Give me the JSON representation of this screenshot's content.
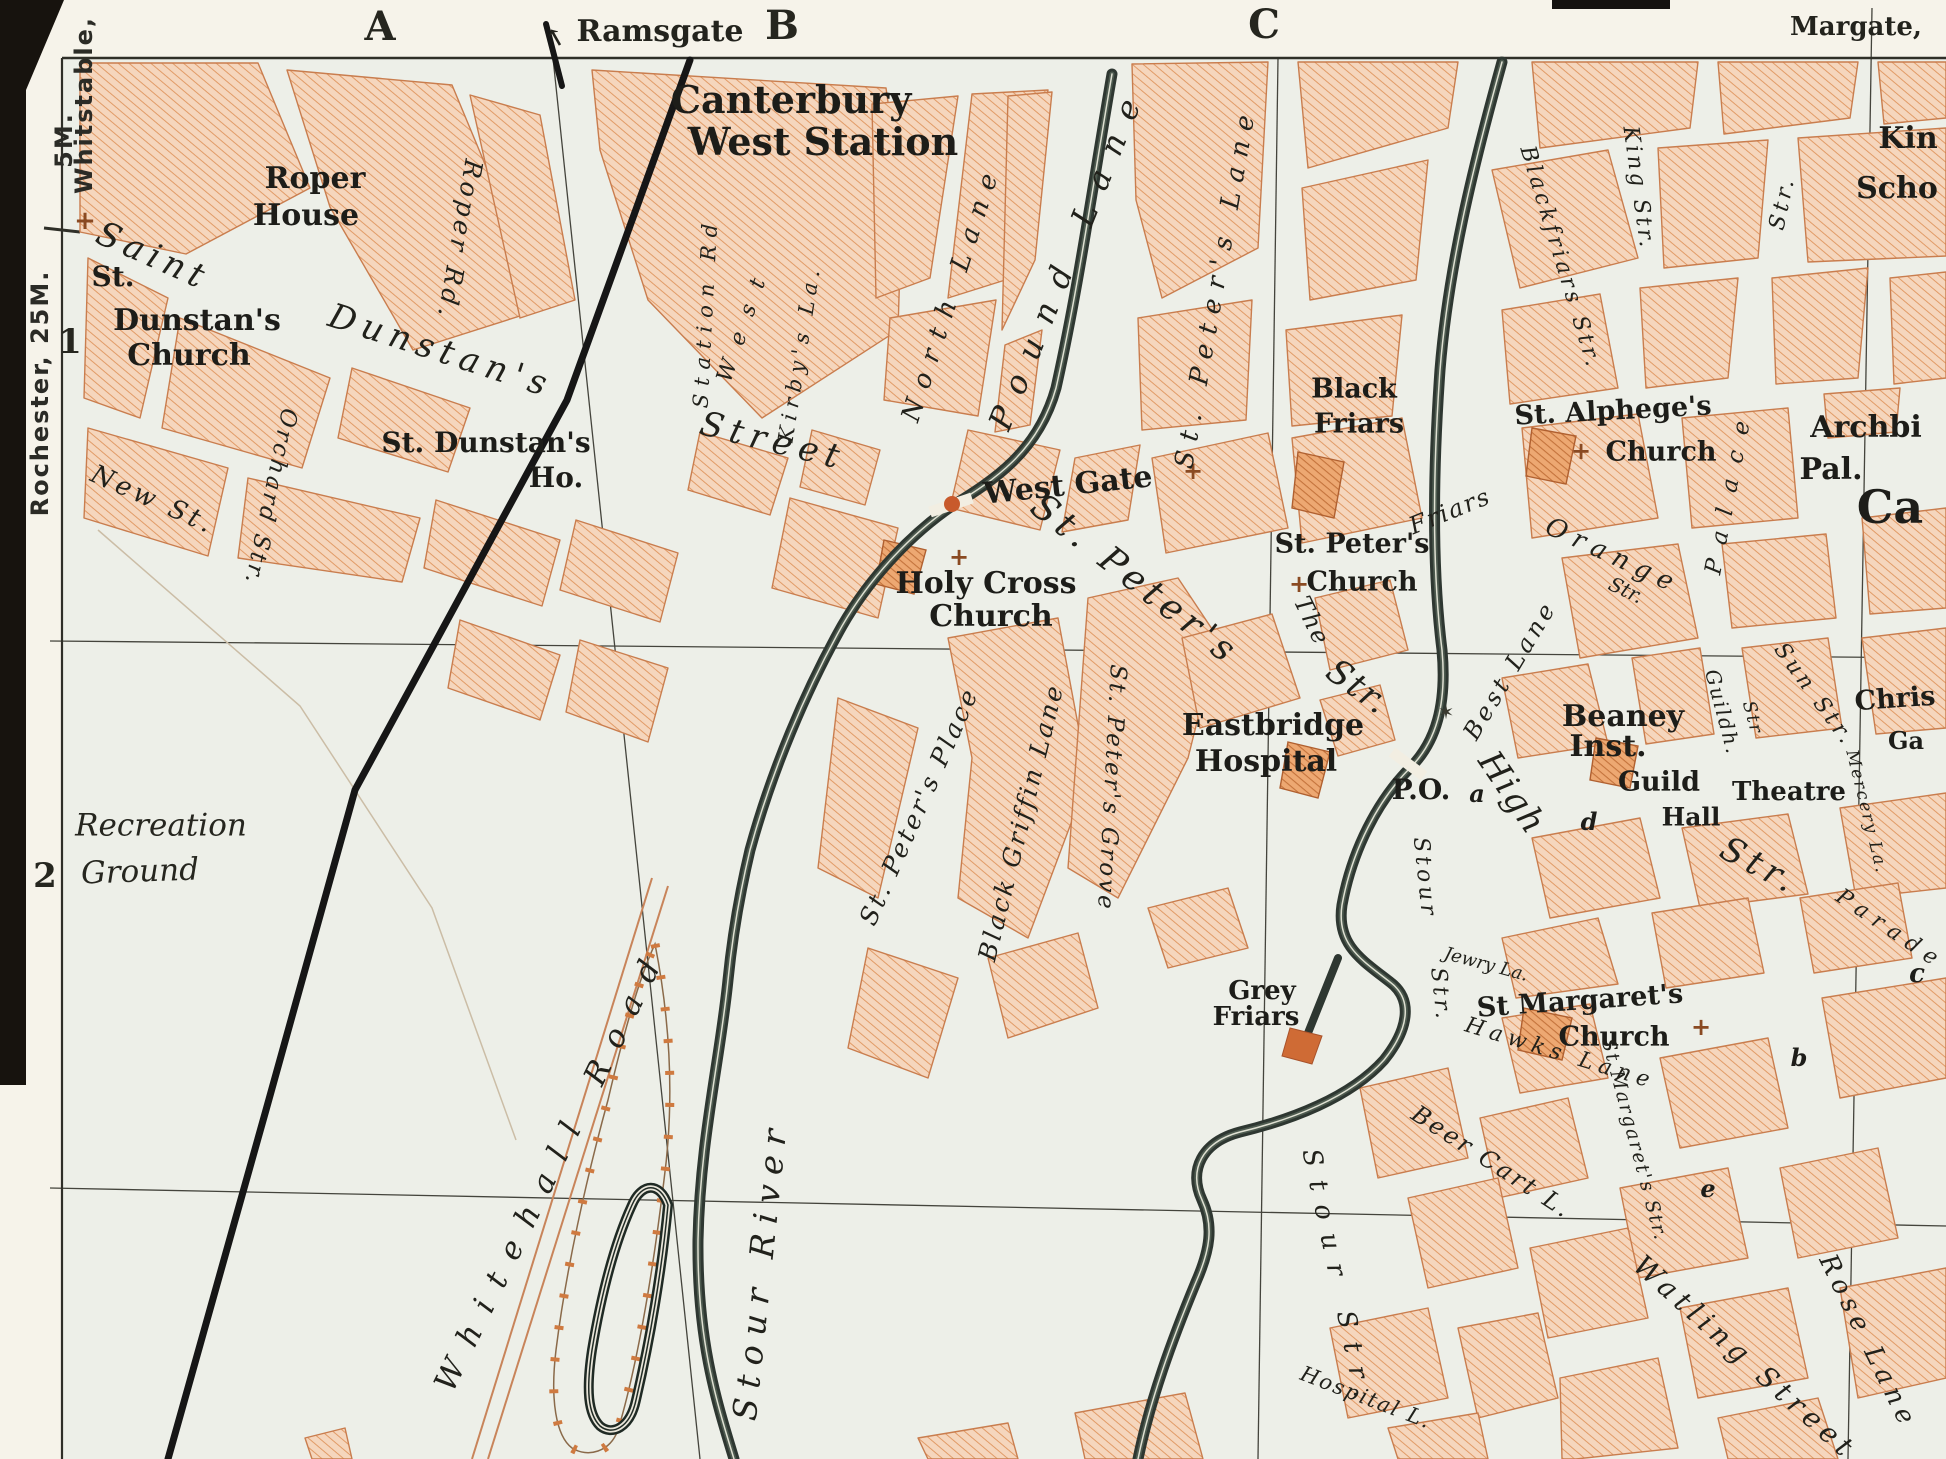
{
  "canvas": {
    "width": 1946,
    "height": 1459
  },
  "palette": {
    "paper": "#edefe8",
    "margin_paper": "#f6f3ea",
    "block_fill": "#f5d6bd",
    "block_hatch": "#e19b67",
    "block_outline": "#c97d4e",
    "public_fill": "#eda872",
    "public_hatch": "#c4733c",
    "river": "#2e3731",
    "railway": "#161616",
    "grid_line": "#44443c",
    "photo_edge": "#17130e",
    "gate_dot": "#c85a2c"
  },
  "labels": [
    {
      "t": "A",
      "x": 380,
      "y": 27,
      "s": 40,
      "k": "grid"
    },
    {
      "t": "B",
      "x": 782,
      "y": 26,
      "s": 40,
      "k": "grid"
    },
    {
      "t": "C",
      "x": 1264,
      "y": 25,
      "s": 40,
      "k": "grid"
    },
    {
      "t": "1",
      "x": 70,
      "y": 342,
      "s": 34,
      "k": "grid"
    },
    {
      "t": "2",
      "x": 45,
      "y": 876,
      "s": 34,
      "k": "grid"
    },
    {
      "t": "Ramsgate",
      "x": 660,
      "y": 32,
      "s": 30,
      "k": "dest"
    },
    {
      "t": "↑",
      "x": 556,
      "y": 38,
      "r": -30,
      "s": 24,
      "k": "dest"
    },
    {
      "t": "Margate,",
      "x": 1856,
      "y": 27,
      "s": 26,
      "k": "dest"
    },
    {
      "t": "Rochester, 25M.",
      "x": 40,
      "y": 393,
      "r": -90,
      "s": 24,
      "k": "margin"
    },
    {
      "t": "Whitstable,",
      "x": 84,
      "y": 105,
      "r": -90,
      "s": 24,
      "k": "margin"
    },
    {
      "t": "5M.",
      "x": 64,
      "y": 140,
      "r": -90,
      "s": 24,
      "k": "margin"
    },
    {
      "t": "Roper",
      "x": 315,
      "y": 179,
      "s": 30,
      "k": "place"
    },
    {
      "t": "House",
      "x": 306,
      "y": 216,
      "s": 30,
      "k": "place"
    },
    {
      "t": "St.",
      "x": 113,
      "y": 277,
      "s": 28,
      "k": "place"
    },
    {
      "t": "Dunstan's",
      "x": 197,
      "y": 321,
      "s": 30,
      "k": "place"
    },
    {
      "t": "Church",
      "x": 189,
      "y": 356,
      "s": 30,
      "k": "place"
    },
    {
      "t": "Canterbury",
      "x": 791,
      "y": 100,
      "s": 38,
      "k": "place"
    },
    {
      "t": "West Station",
      "x": 823,
      "y": 142,
      "s": 38,
      "k": "place"
    },
    {
      "t": "St. Dunstan's",
      "x": 486,
      "y": 443,
      "s": 28,
      "k": "place"
    },
    {
      "t": "Ho.",
      "x": 556,
      "y": 478,
      "s": 28,
      "k": "place"
    },
    {
      "t": "West Gate",
      "x": 1068,
      "y": 486,
      "r": -6,
      "s": 30,
      "k": "place"
    },
    {
      "t": "Holy Cross",
      "x": 986,
      "y": 584,
      "s": 30,
      "k": "place"
    },
    {
      "t": "Church",
      "x": 991,
      "y": 617,
      "s": 30,
      "k": "place"
    },
    {
      "t": "St. Peter's",
      "x": 1352,
      "y": 544,
      "s": 27,
      "k": "place"
    },
    {
      "t": "Church",
      "x": 1362,
      "y": 582,
      "s": 27,
      "k": "place"
    },
    {
      "t": "Black",
      "x": 1354,
      "y": 389,
      "s": 27,
      "k": "place"
    },
    {
      "t": "Friars",
      "x": 1359,
      "y": 424,
      "s": 27,
      "k": "place"
    },
    {
      "t": "St. Alphege's",
      "x": 1613,
      "y": 411,
      "r": -3,
      "s": 27,
      "k": "place"
    },
    {
      "t": "Church",
      "x": 1661,
      "y": 452,
      "s": 27,
      "k": "place"
    },
    {
      "t": "Archbi",
      "x": 1866,
      "y": 428,
      "s": 30,
      "k": "place"
    },
    {
      "t": "Pal.",
      "x": 1831,
      "y": 470,
      "s": 30,
      "k": "place"
    },
    {
      "t": "Kin",
      "x": 1908,
      "y": 139,
      "s": 30,
      "k": "place"
    },
    {
      "t": "Scho",
      "x": 1897,
      "y": 189,
      "s": 30,
      "k": "place"
    },
    {
      "t": "Ca",
      "x": 1890,
      "y": 507,
      "s": 46,
      "k": "place"
    },
    {
      "t": "Chris",
      "x": 1895,
      "y": 699,
      "r": -4,
      "s": 27,
      "k": "place"
    },
    {
      "t": "Ga",
      "x": 1906,
      "y": 741,
      "s": 24,
      "k": "place"
    },
    {
      "t": "Eastbridge",
      "x": 1273,
      "y": 726,
      "s": 30,
      "k": "place"
    },
    {
      "t": "Hospital",
      "x": 1266,
      "y": 762,
      "s": 30,
      "k": "place"
    },
    {
      "t": "P.O.",
      "x": 1421,
      "y": 790,
      "s": 28,
      "k": "place"
    },
    {
      "t": "Beaney",
      "x": 1623,
      "y": 717,
      "s": 30,
      "k": "place"
    },
    {
      "t": "Inst.",
      "x": 1608,
      "y": 747,
      "s": 30,
      "k": "place"
    },
    {
      "t": "Guild",
      "x": 1659,
      "y": 782,
      "s": 27,
      "k": "place"
    },
    {
      "t": "Hall",
      "x": 1691,
      "y": 817,
      "s": 25,
      "k": "place"
    },
    {
      "t": "Theatre",
      "x": 1789,
      "y": 792,
      "s": 26,
      "k": "place"
    },
    {
      "t": "Grey",
      "x": 1262,
      "y": 991,
      "s": 26,
      "k": "place"
    },
    {
      "t": "Friars",
      "x": 1256,
      "y": 1017,
      "s": 26,
      "k": "place"
    },
    {
      "t": "St Margaret's",
      "x": 1580,
      "y": 1001,
      "r": -4,
      "s": 27,
      "k": "place"
    },
    {
      "t": "Church",
      "x": 1614,
      "y": 1037,
      "s": 27,
      "k": "place"
    },
    {
      "t": "Recreation",
      "x": 161,
      "y": 826,
      "s": 31,
      "k": "placei"
    },
    {
      "t": "Ground",
      "x": 140,
      "y": 872,
      "r": -2,
      "s": 31,
      "k": "placei"
    },
    {
      "t": "a",
      "x": 1477,
      "y": 794,
      "s": 24,
      "k": "marker"
    },
    {
      "t": "d",
      "x": 1589,
      "y": 822,
      "s": 24,
      "k": "marker"
    },
    {
      "t": "b",
      "x": 1799,
      "y": 1058,
      "s": 24,
      "k": "marker"
    },
    {
      "t": "e",
      "x": 1708,
      "y": 1189,
      "s": 24,
      "k": "marker"
    },
    {
      "t": "c",
      "x": 1917,
      "y": 974,
      "s": 26,
      "k": "marker"
    },
    {
      "t": "+",
      "x": 85,
      "y": 221,
      "s": 26,
      "k": "cross"
    },
    {
      "t": "+",
      "x": 1193,
      "y": 471,
      "s": 24,
      "k": "cross"
    },
    {
      "t": "+",
      "x": 959,
      "y": 557,
      "s": 24,
      "k": "cross"
    },
    {
      "t": "+",
      "x": 1299,
      "y": 584,
      "s": 24,
      "k": "cross"
    },
    {
      "t": "+",
      "x": 1581,
      "y": 451,
      "s": 24,
      "k": "cross"
    },
    {
      "t": "+",
      "x": 1701,
      "y": 1027,
      "s": 24,
      "k": "cross"
    },
    {
      "t": "✶",
      "x": 1446,
      "y": 712,
      "s": 20,
      "k": "star"
    },
    {
      "t": "Saint",
      "x": 153,
      "y": 256,
      "r": 24,
      "s": 34,
      "ls": 6,
      "k": "street"
    },
    {
      "t": "Dunstan's",
      "x": 441,
      "y": 351,
      "r": 18,
      "s": 34,
      "ls": 7,
      "k": "street"
    },
    {
      "t": "Street",
      "x": 773,
      "y": 441,
      "r": 14,
      "s": 34,
      "ls": 7,
      "k": "street"
    },
    {
      "t": "New St.",
      "x": 153,
      "y": 500,
      "r": 24,
      "s": 26,
      "ls": 4,
      "k": "street"
    },
    {
      "t": "Orchard Str.",
      "x": 270,
      "y": 497,
      "r": 102,
      "s": 23,
      "ls": 3,
      "k": "street"
    },
    {
      "t": "Roper Rd.",
      "x": 460,
      "y": 240,
      "r": 100,
      "s": 25,
      "ls": 4,
      "k": "street"
    },
    {
      "t": "Station Rd",
      "x": 706,
      "y": 312,
      "r": -87,
      "s": 21,
      "ls": 8,
      "k": "street"
    },
    {
      "t": "West",
      "x": 745,
      "y": 322,
      "r": -71,
      "s": 22,
      "ls": 18,
      "k": "street"
    },
    {
      "t": "Kirby's La.",
      "x": 800,
      "y": 353,
      "r": -81,
      "s": 21,
      "ls": 6,
      "k": "street"
    },
    {
      "t": "North Lane",
      "x": 952,
      "y": 292,
      "r": -72,
      "s": 26,
      "ls": 12,
      "k": "street"
    },
    {
      "t": "Pound Lane",
      "x": 1068,
      "y": 256,
      "r": -68,
      "s": 32,
      "ls": 18,
      "k": "street"
    },
    {
      "t": "St. Peter's Lane",
      "x": 1216,
      "y": 287,
      "r": -80,
      "s": 26,
      "ls": 10,
      "k": "street"
    },
    {
      "t": "St. Peter's",
      "x": 1135,
      "y": 580,
      "r": 38,
      "s": 36,
      "ls": 6,
      "k": "street"
    },
    {
      "t": "Str.",
      "x": 1358,
      "y": 687,
      "r": 36,
      "s": 34,
      "ls": 2,
      "k": "street"
    },
    {
      "t": "Blackfriars Str.",
      "x": 1560,
      "y": 258,
      "r": 73,
      "s": 22,
      "ls": 4,
      "k": "street"
    },
    {
      "t": "King Str.",
      "x": 1638,
      "y": 188,
      "r": 82,
      "s": 22,
      "ls": 3,
      "k": "street"
    },
    {
      "t": "The",
      "x": 1312,
      "y": 621,
      "r": 64,
      "s": 24,
      "ls": 2,
      "k": "street"
    },
    {
      "t": "Friars",
      "x": 1450,
      "y": 511,
      "r": -22,
      "s": 24,
      "ls": 2,
      "k": "street"
    },
    {
      "t": "Orange",
      "x": 1613,
      "y": 556,
      "r": 25,
      "s": 26,
      "ls": 8,
      "k": "street"
    },
    {
      "t": "Str.",
      "x": 1626,
      "y": 590,
      "r": 25,
      "s": 20,
      "k": "street"
    },
    {
      "t": "Palace",
      "x": 1730,
      "y": 490,
      "r": -79,
      "s": 23,
      "ls": 16,
      "k": "street"
    },
    {
      "t": "Str.",
      "x": 1783,
      "y": 203,
      "r": -78,
      "s": 22,
      "ls": 4,
      "k": "street"
    },
    {
      "t": "Sun Str.",
      "x": 1814,
      "y": 695,
      "r": 54,
      "s": 22,
      "ls": 4,
      "k": "street"
    },
    {
      "t": "Guildh.",
      "x": 1723,
      "y": 712,
      "r": 75,
      "s": 20,
      "ls": 2,
      "k": "street"
    },
    {
      "t": "Str",
      "x": 1752,
      "y": 718,
      "r": 75,
      "s": 18,
      "ls": 2,
      "k": "street"
    },
    {
      "t": "Best Lane",
      "x": 1510,
      "y": 670,
      "r": -59,
      "s": 24,
      "ls": 4,
      "k": "street"
    },
    {
      "t": "High",
      "x": 1512,
      "y": 793,
      "r": 56,
      "s": 34,
      "ls": 2,
      "k": "street"
    },
    {
      "t": "Str.",
      "x": 1760,
      "y": 866,
      "r": 28,
      "s": 34,
      "ls": 6,
      "k": "street"
    },
    {
      "t": "Mercery La.",
      "x": 1866,
      "y": 812,
      "r": 76,
      "s": 17,
      "ls": 2,
      "k": "street"
    },
    {
      "t": "Parade",
      "x": 1890,
      "y": 930,
      "r": 34,
      "s": 22,
      "ls": 8,
      "k": "street"
    },
    {
      "t": "St Margaret's Str.",
      "x": 1634,
      "y": 1140,
      "r": 75,
      "s": 19,
      "ls": 2,
      "k": "street"
    },
    {
      "t": "Hawks Lane",
      "x": 1560,
      "y": 1054,
      "r": 17,
      "s": 22,
      "ls": 6,
      "k": "street"
    },
    {
      "t": "Jewry La.",
      "x": 1486,
      "y": 965,
      "r": 15,
      "s": 18,
      "k": "street"
    },
    {
      "t": "Beer Cart L.",
      "x": 1492,
      "y": 1162,
      "r": 33,
      "s": 24,
      "ls": 3,
      "k": "street"
    },
    {
      "t": "Watling Street",
      "x": 1745,
      "y": 1358,
      "r": 42,
      "s": 28,
      "ls": 6,
      "k": "street"
    },
    {
      "t": "Rose Lane",
      "x": 1868,
      "y": 1342,
      "r": 64,
      "s": 26,
      "ls": 6,
      "k": "street"
    },
    {
      "t": "Stour",
      "x": 1424,
      "y": 878,
      "r": 84,
      "s": 22,
      "ls": 4,
      "k": "street"
    },
    {
      "t": "Str.",
      "x": 1440,
      "y": 995,
      "r": 84,
      "s": 22,
      "ls": 4,
      "k": "street"
    },
    {
      "t": "Stour Str.",
      "x": 1338,
      "y": 1280,
      "r": 78,
      "s": 26,
      "ls": 14,
      "k": "street"
    },
    {
      "t": "Hospital L.",
      "x": 1366,
      "y": 1398,
      "r": 21,
      "s": 21,
      "ls": 2,
      "k": "street"
    },
    {
      "t": "St. Peter's Place",
      "x": 919,
      "y": 806,
      "r": -66,
      "s": 25,
      "ls": 3,
      "k": "street"
    },
    {
      "t": "Black Griffin Lane",
      "x": 1021,
      "y": 822,
      "r": -76,
      "s": 25,
      "ls": 3,
      "k": "street"
    },
    {
      "t": "St. Peter's Grove",
      "x": 1111,
      "y": 788,
      "r": 93,
      "s": 23,
      "ls": 3,
      "k": "street"
    },
    {
      "t": "Whitehall Road",
      "x": 552,
      "y": 1168,
      "r": -64,
      "s": 31,
      "ls": 18,
      "k": "street"
    },
    {
      "t": "Stour River",
      "x": 760,
      "y": 1270,
      "r": -84,
      "s": 33,
      "ls": 10,
      "k": "street"
    }
  ]
}
